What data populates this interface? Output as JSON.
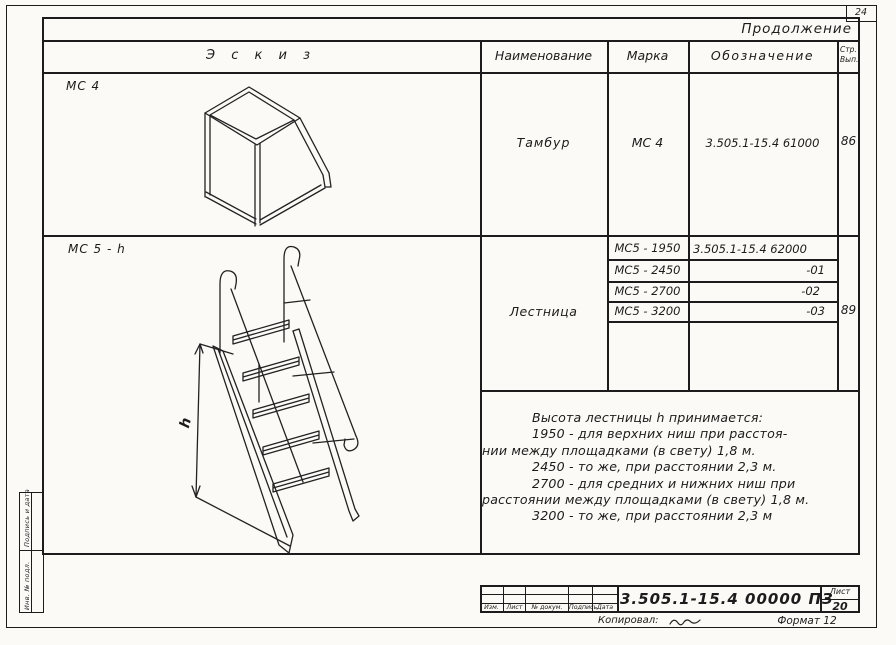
{
  "page": {
    "corner_page_number": "24",
    "continuation": "Продолжение",
    "doc_designation": "3.505.1-15.4   00000 ПЗ",
    "sheet_label": "Лист",
    "sheet_number": "20",
    "copied_label": "Копировал:",
    "format_note": "Формат 12",
    "revision_labels": [
      "Изм.",
      "Лист",
      "№ докум.",
      "Подпись",
      "Дата"
    ],
    "side_stamp_top": "Подпись и дата",
    "side_stamp_bottom": "Инв. № подл."
  },
  "table": {
    "header_sketch": "Э с к и з",
    "header_name": "Наименование",
    "header_mark": "Марка",
    "header_designation": "Обозначение",
    "header_page_line1": "Стр.",
    "header_page_line2": "Вып.",
    "row1": {
      "sketch_label": "МС 4",
      "name": "Тамбур",
      "mark": "МС 4",
      "designation": "3.505.1-15.4 61000",
      "page": "86"
    },
    "row2": {
      "sketch_label": "МС 5 - h",
      "name": "Лестница",
      "marks": [
        "МС5 - 1950",
        "МС5 - 2450",
        "МС5 - 2700",
        "МС5 - 3200"
      ],
      "designations": [
        "3.505.1-15.4  62000",
        "-01",
        "-02",
        "-03"
      ],
      "page": "89",
      "dimension_label": "h"
    }
  },
  "note": {
    "lines": [
      "Высота лестницы h принимается:",
      "1950 - для верхних ниш при расстоя-",
      "нии между площадками (в свету) 1,8 м.",
      "2450 - то же, при расстоянии 2,3 м.",
      "2700 - для средних и нижних ниш при",
      "расстоянии между площадками (в свету) 1,8 м.",
      "3200 - то же, при расстоянии  2,3 м"
    ]
  }
}
